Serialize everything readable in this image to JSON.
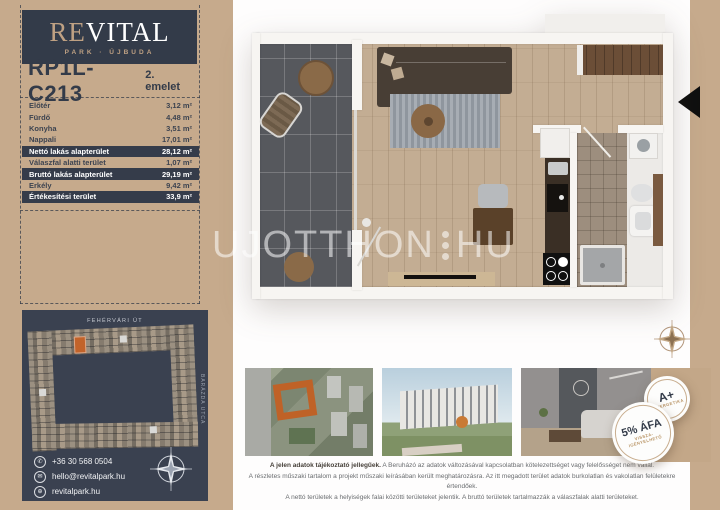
{
  "brand": {
    "re": "RE",
    "vital": "VITAL",
    "subtitle": "PARK · ÚJBUDA"
  },
  "header": {
    "unit_id": "RP1L-C213",
    "floor": "2. emelet"
  },
  "area_table": {
    "rows": [
      {
        "label": "Előtér",
        "value": "3,12 m²",
        "highlight": false
      },
      {
        "label": "Fürdő",
        "value": "4,48 m²",
        "highlight": false
      },
      {
        "label": "Konyha",
        "value": "3,51 m²",
        "highlight": false
      },
      {
        "label": "Nappali",
        "value": "17,01 m²",
        "highlight": false
      },
      {
        "label": "Nettó lakás alapterület",
        "value": "28,12 m²",
        "highlight": true
      },
      {
        "label": "Válaszfal alatti terület",
        "value": "1,07 m²",
        "highlight": false
      },
      {
        "label": "Bruttó lakás alapterület",
        "value": "29,19 m²",
        "highlight": true
      },
      {
        "label": "Erkély",
        "value": "9,42 m²",
        "highlight": false
      },
      {
        "label": "Értékesítési terület",
        "value": "33,9 m²",
        "highlight": true
      }
    ]
  },
  "site_plan": {
    "street_top": "FEHÉRVÁRI ÚT",
    "street_right": "BARÁZDA UTCA"
  },
  "contact": {
    "phone": "+36 30 568 0504",
    "email": "hello@revitalpark.hu",
    "website": "revitalpark.hu"
  },
  "watermark": {
    "left": "UJOTTHON",
    "right": "HU"
  },
  "badges": {
    "energy_title": "A+",
    "energy_sub": "ENERGETIKA",
    "vat_title": "5% ÁFA",
    "vat_sub1": "VISSZA-",
    "vat_sub2": "IGÉNYELHETŐ"
  },
  "disclaimer": {
    "intro_bold": "A jelen adatok tájékoztató jellegűek.",
    "line1_rest": " A Beruházó az adatok változásával kapcsolatban kötelezettséget vagy felelősséget nem vállal.",
    "line2": "A részletes műszaki tartalom a projekt műszaki leírásában került meghatározásra. Az itt megadott terület adatok burkolatlan és vakolatlan felületekre értendőek.",
    "line3": "A nettó területek a helyiségek falai közötti területeket jelentik. A bruttó területek tartalmazzák a válaszfalak alatti területeket."
  },
  "colors": {
    "tan": "#c6aa8c",
    "navy": "#333b49",
    "gold": "#bfa183",
    "highlight_orange": "#c2632a"
  }
}
